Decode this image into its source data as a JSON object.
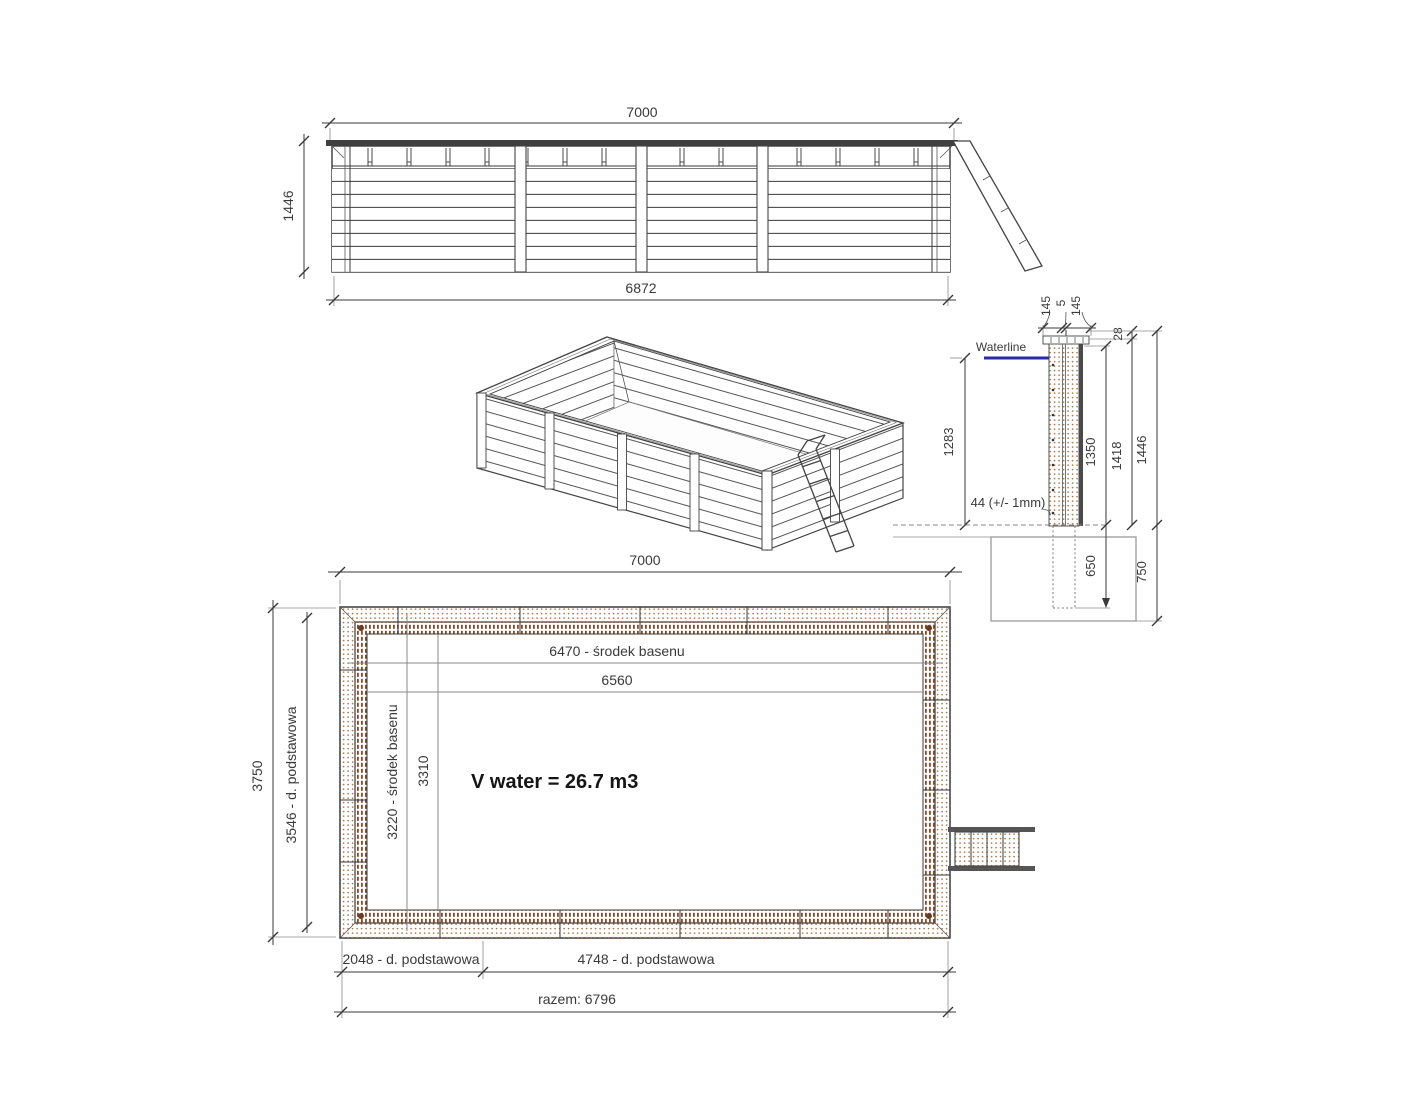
{
  "colors": {
    "line": "#4a4a4a",
    "dim_text": "#3a3a3a",
    "waterline": "#2a2aad",
    "wood_dot": "#b07c50",
    "wood_hatch": "#8a4a28",
    "footing": "#9a9a9a"
  },
  "elevation": {
    "dim_width_top": "7000",
    "dim_height_left": "1446",
    "dim_width_bottom": "6872"
  },
  "section": {
    "waterline_label": "Waterline",
    "dim_board_outer": "145",
    "dim_board_gap": "5",
    "dim_board_inner": "145",
    "dim_cap_height": "28",
    "dim_waterline_height": "1283",
    "dim_wall_inner_height": "1350",
    "dim_wall_mid_height": "1418",
    "dim_wall_total_height": "1446",
    "board_thickness_note": "44 (+/- 1mm)",
    "dim_post_embed": "650",
    "dim_foundation_depth": "750"
  },
  "plan": {
    "dim_width_top": "7000",
    "dim_center_length": "6470 - środek basenu",
    "dim_inner_length": "6560",
    "dim_outer_width": "3750",
    "dim_base_width": "3546 - d. podstawowa",
    "dim_center_width": "3220 - środek basenu",
    "dim_inner_width": "3310",
    "volume_note": "V water = 26.7 m3",
    "dim_base_left": "2048 - d. podstawowa",
    "dim_base_right": "4748 - d. podstawowa",
    "dim_total_bottom": "razem: 6796"
  }
}
